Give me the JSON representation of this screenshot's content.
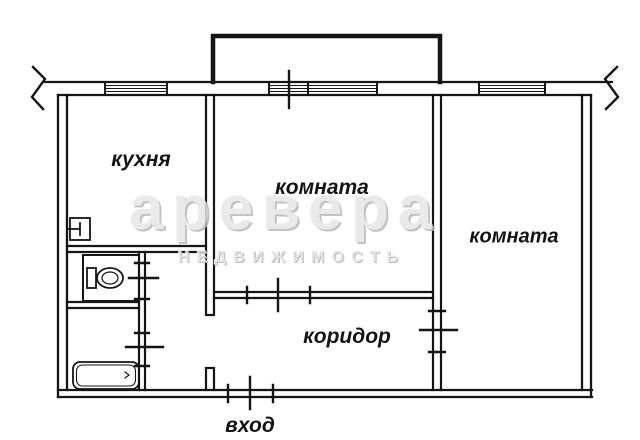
{
  "colors": {
    "line": "#151515",
    "background": "#ffffff",
    "watermark_text": "#e6e6e6"
  },
  "floor_plan": {
    "labels": {
      "kitchen": "кухня",
      "room_main": "комната",
      "room_right": "комната",
      "corridor": "коридор",
      "entrance": "вход"
    }
  },
  "watermark": {
    "brand": "аревера",
    "tagline": "НЕДВИЖИМОСТЬ"
  }
}
